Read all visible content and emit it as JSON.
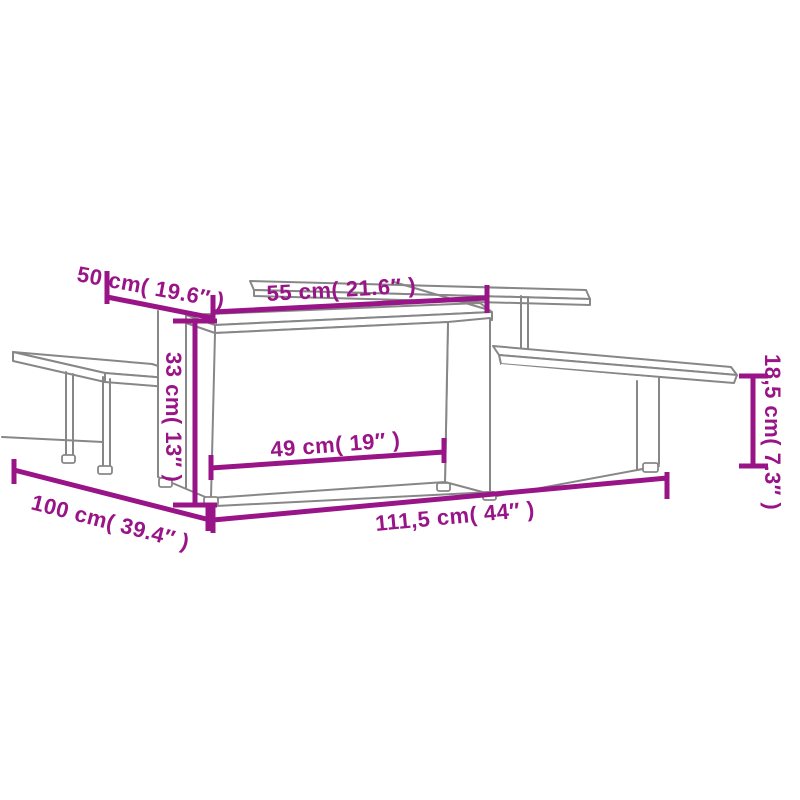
{
  "product_diagram": {
    "type": "furniture-dimension-diagram",
    "subject": "set of two interlocking coffee tables, line drawing",
    "colors": {
      "background": "#ffffff",
      "dimension_color": "#981487",
      "outline_color": "#878787"
    },
    "labels": {
      "top_depth": "50 cm( 19.6″ )",
      "upper_shelf_width": "55 cm( 21.6″ )",
      "tall_table_height": "33 cm( 13″ )",
      "low_table_height": "18,5 cm( 7.3″ )",
      "inner_clearance_width": "49 cm( 19″ )",
      "base_depth": "100 cm( 39.4″ )",
      "total_length": "111,5 cm( 44″ )"
    }
  }
}
